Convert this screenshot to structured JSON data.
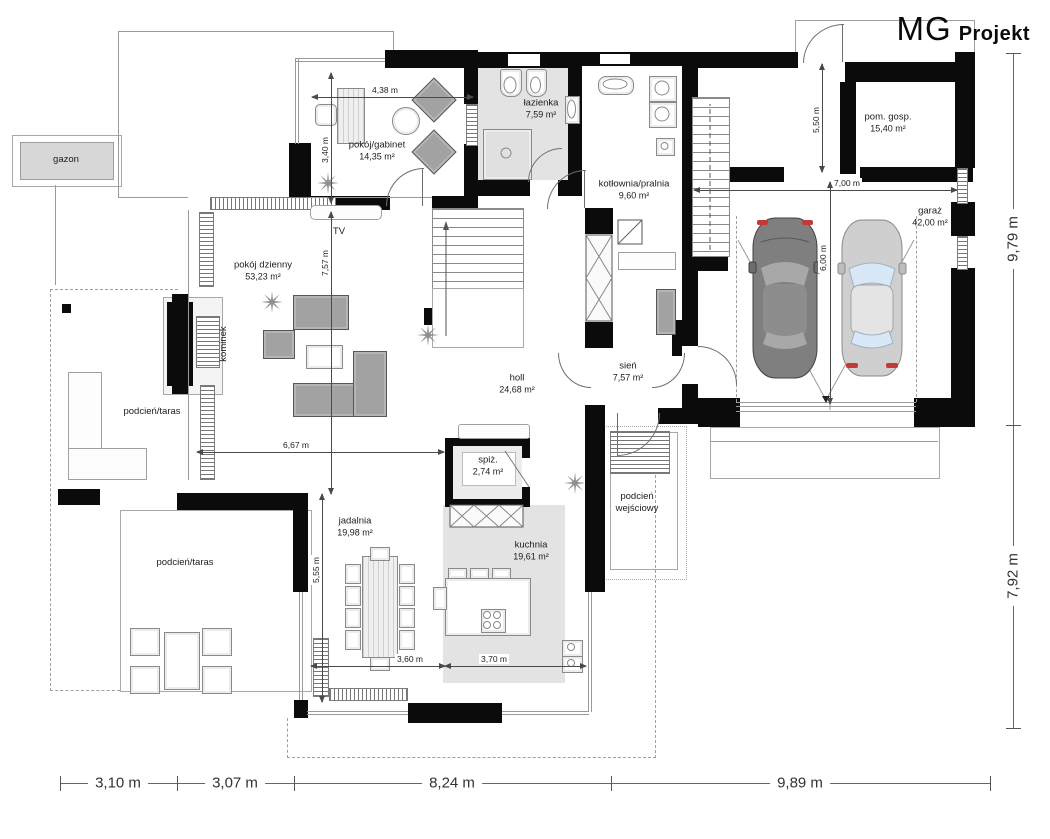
{
  "logo": {
    "mg": "MG",
    "projekt": "Projekt"
  },
  "colors": {
    "wall": "#0b0b0b",
    "floor_gray": "#e3e3e3",
    "car_dark": "#7f7f7f",
    "car_light": "#cfcfcf",
    "glass_blue": "#d9e8f6",
    "accent_red": "#c23b3b"
  },
  "rooms": [
    {
      "id": "gabinet",
      "name": "pokój/gabinet",
      "area": "14,35 m²",
      "x": 377,
      "y": 151
    },
    {
      "id": "lazienka",
      "name": "łazienka",
      "area": "7,59 m²",
      "x": 541,
      "y": 109
    },
    {
      "id": "kotlownia",
      "name": "kotłownia/pralnia",
      "area": "9,60 m²",
      "x": 634,
      "y": 190
    },
    {
      "id": "pomgosp",
      "name": "pom. gosp.",
      "area": "15,40 m²",
      "x": 888,
      "y": 123
    },
    {
      "id": "garaz",
      "name": "garaż",
      "area": "42,00 m²",
      "x": 930,
      "y": 217
    },
    {
      "id": "dzienny",
      "name": "pokój dzienny",
      "area": "53,23 m²",
      "x": 263,
      "y": 271
    },
    {
      "id": "holl",
      "name": "holl",
      "area": "24,68 m²",
      "x": 517,
      "y": 384
    },
    {
      "id": "sien",
      "name": "sień",
      "area": "7,57 m²",
      "x": 628,
      "y": 372
    },
    {
      "id": "spiz",
      "name": "spiż.",
      "area": "2,74 m²",
      "x": 488,
      "y": 466
    },
    {
      "id": "jadalnia",
      "name": "jadalnia",
      "area": "19,98 m²",
      "x": 355,
      "y": 527
    },
    {
      "id": "kuchnia",
      "name": "kuchnia",
      "area": "19,61 m²",
      "x": 531,
      "y": 551
    }
  ],
  "annotations": [
    {
      "id": "gazon",
      "text": "gazon",
      "x": 66,
      "y": 160
    },
    {
      "id": "tv",
      "text": "TV",
      "x": 339,
      "y": 232
    },
    {
      "id": "kominek",
      "text": "kominek",
      "x": 224,
      "y": 344,
      "rot": true
    },
    {
      "id": "taras1",
      "text": "podcień/taras",
      "x": 152,
      "y": 412
    },
    {
      "id": "taras2",
      "text": "podcień/taras",
      "x": 185,
      "y": 563
    },
    {
      "id": "wejsciowy",
      "text": "podcień\nwejściowy",
      "x": 637,
      "y": 503
    }
  ],
  "dims": {
    "internal": [
      {
        "id": "d438",
        "label": "4,38 m",
        "dir": "h",
        "x": 312,
        "y": 97,
        "len": 161,
        "lx": 385,
        "ly": 90
      },
      {
        "id": "d340",
        "label": "3,40 m",
        "dir": "v",
        "x": 331,
        "y": 73,
        "len": 130,
        "lx": 325,
        "ly": 150
      },
      {
        "id": "d757",
        "label": "7,57 m",
        "dir": "v",
        "x": 331,
        "y": 212,
        "len": 282,
        "lx": 325,
        "ly": 263
      },
      {
        "id": "d667",
        "label": "6,67 m",
        "dir": "h",
        "x": 197,
        "y": 452,
        "len": 247,
        "lx": 296,
        "ly": 445
      },
      {
        "id": "d555",
        "label": "5,55 m",
        "dir": "v",
        "x": 322,
        "y": 494,
        "len": 208,
        "lx": 316,
        "ly": 570
      },
      {
        "id": "d360",
        "label": "3,60 m",
        "dir": "h",
        "x": 311,
        "y": 666,
        "len": 134,
        "lx": 410,
        "ly": 659
      },
      {
        "id": "d370",
        "label": "3,70 m",
        "dir": "h",
        "x": 445,
        "y": 666,
        "len": 141,
        "lx": 494,
        "ly": 659
      },
      {
        "id": "d700",
        "label": "7,00 m",
        "dir": "h",
        "x": 694,
        "y": 190,
        "len": 263,
        "lx": 847,
        "ly": 183
      },
      {
        "id": "d600",
        "label": "6,00 m",
        "dir": "v",
        "x": 830,
        "y": 182,
        "len": 222,
        "lx": 823,
        "ly": 258
      },
      {
        "id": "d550",
        "label": "5,50 m",
        "dir": "v",
        "x": 822,
        "y": 64,
        "len": 108,
        "lx": 816,
        "ly": 120
      }
    ],
    "bottom": {
      "y": 783,
      "x1": 60,
      "x2": 990,
      "ticks": [
        60,
        177,
        294,
        611,
        990
      ],
      "segments": [
        {
          "label": "3,10 m",
          "cx": 118
        },
        {
          "label": "3,07 m",
          "cx": 235
        },
        {
          "label": "8,24 m",
          "cx": 452
        },
        {
          "label": "9,89 m",
          "cx": 800
        }
      ]
    },
    "right": {
      "x": 1013,
      "y1": 53,
      "y2": 728,
      "ticks": [
        53,
        425,
        728
      ],
      "segments": [
        {
          "label": "9,79 m",
          "cy": 239
        },
        {
          "label": "7,92 m",
          "cy": 576
        }
      ]
    }
  }
}
